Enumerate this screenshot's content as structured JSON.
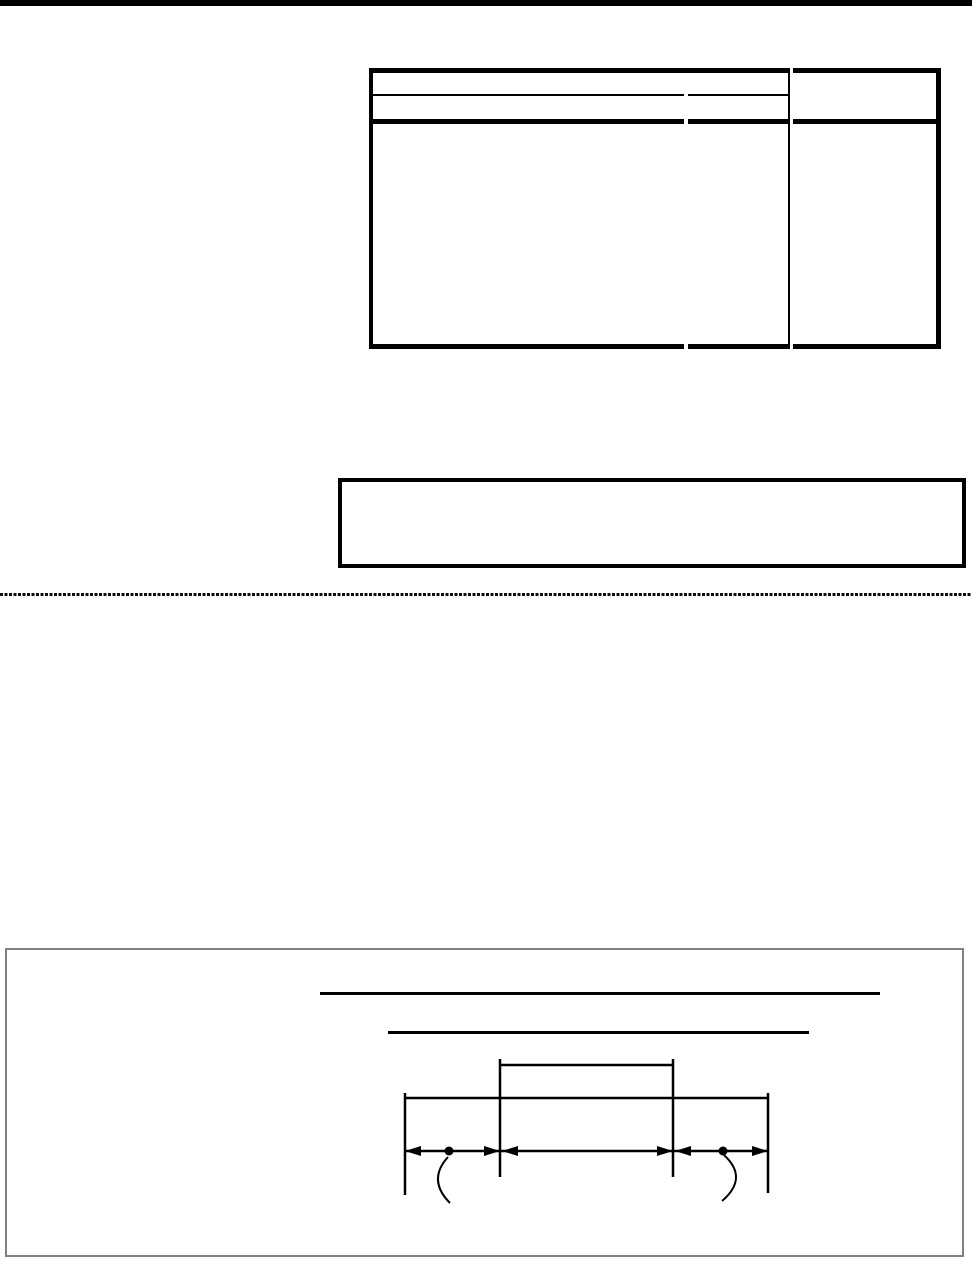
{
  "page": {
    "background": "#ffffff",
    "width_px": 972,
    "height_px": 1266
  },
  "colors": {
    "ink": "#000000",
    "dashed_divider": "#0a0a0a",
    "figure_box_border": "#808080"
  },
  "header": {
    "top_rule_color": "#000000"
  },
  "table": {
    "visible_text": "",
    "header_rows": 2,
    "body_rows": 1,
    "columns": 2
  },
  "note_box": {
    "visible_text": ""
  },
  "figure": {
    "title_text": "",
    "subtitle_text": "",
    "dimension_segments": 3,
    "reference_dots": 2
  }
}
